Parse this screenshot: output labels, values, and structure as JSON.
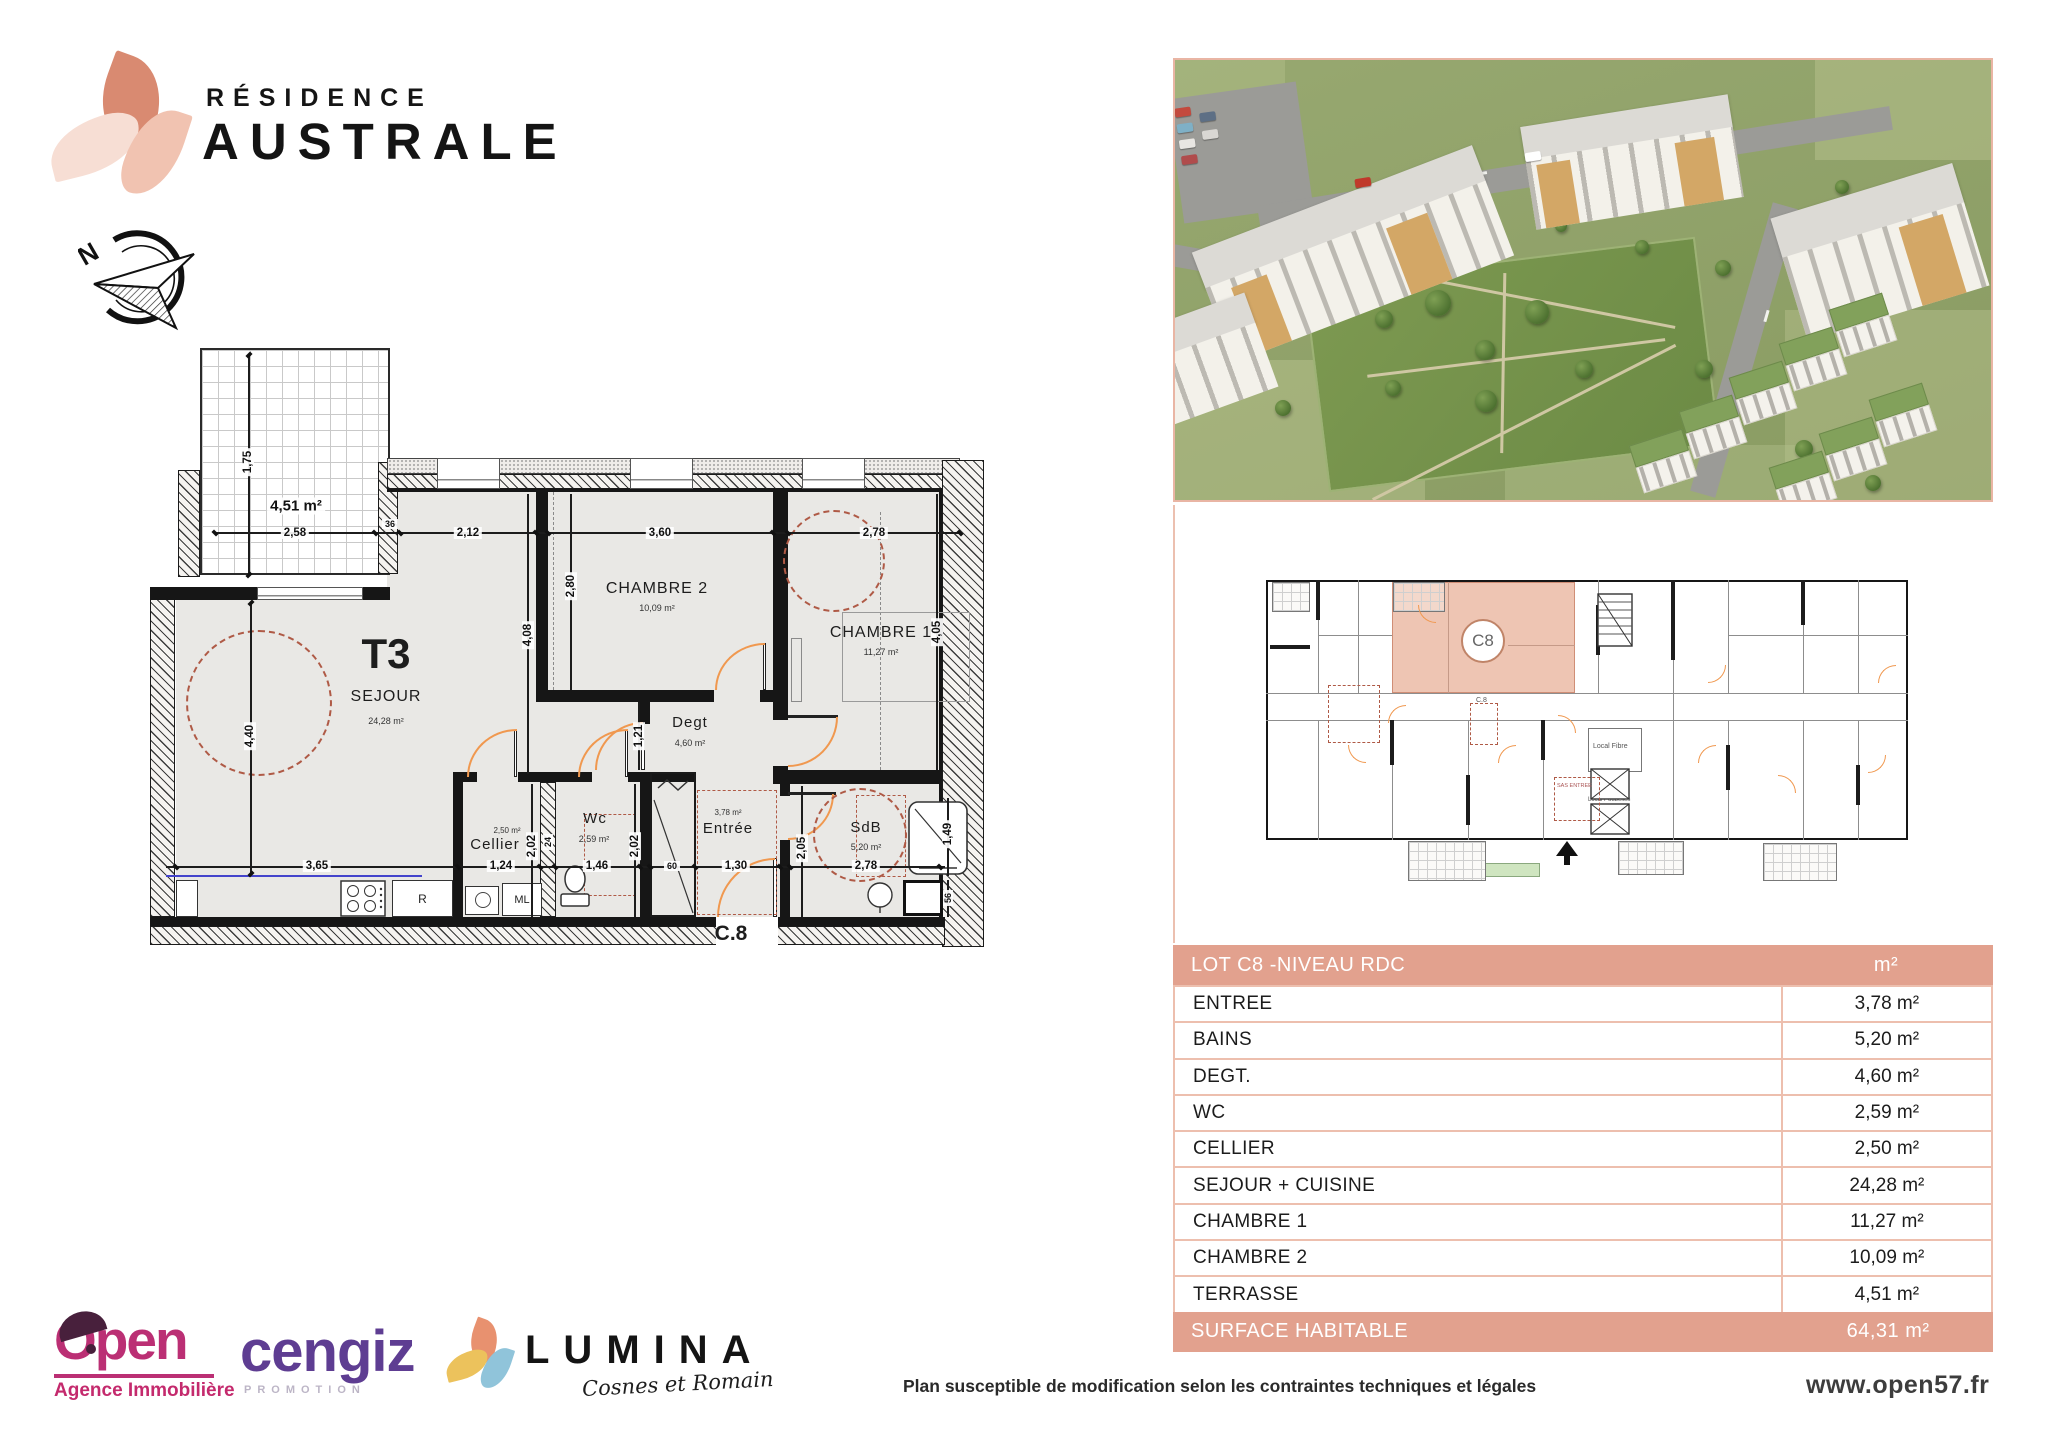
{
  "brand": {
    "line1": "RÉSIDENCE",
    "line2": "AUSTRALE"
  },
  "compass": {
    "north": "N"
  },
  "floor_plan": {
    "type": "T3",
    "lot": "C.8",
    "terrace": {
      "area": "4,51 m²"
    },
    "rooms": {
      "sejour": {
        "name": "SEJOUR",
        "area": "24,28 m²"
      },
      "chambre2": {
        "name": "CHAMBRE 2",
        "area": "10,09 m²"
      },
      "chambre1": {
        "name": "CHAMBRE 1",
        "area": "11,27 m²"
      },
      "degt": {
        "name": "Degt",
        "area": "4,60 m²"
      },
      "wc": {
        "name": "Wc",
        "area": "2,59 m²"
      },
      "cellier": {
        "name": "Cellier",
        "area": "2,50 m²"
      },
      "entree": {
        "name": "Entrée",
        "area": "3,78 m²"
      },
      "sdb": {
        "name": "SdB",
        "area": "5,20 m²"
      }
    },
    "appliances": {
      "fridge": "R",
      "washer": "ML"
    },
    "dims": {
      "terrace_h": "1,75",
      "terrace_w": "2,58",
      "wall36": "36",
      "seg_sejour": "2,12",
      "seg_ch2": "3,60",
      "seg_ch1": "2,78",
      "sejour_h": "4,40",
      "sejour_w": "3,65",
      "inner_col": "4,08",
      "ch2_h": "2,80",
      "ch1_h": "4,05",
      "degt_h": "1,21",
      "cellier_w": "1,24",
      "cellier_h": "2,02",
      "wc_w": "1,46",
      "wc_h": "2,02",
      "closet_w": "60",
      "entree_w": "1,30",
      "sdb_h": "2,05",
      "sdb_w": "2,78",
      "shower_h": "1,49",
      "shower_w": "56",
      "shaft_w": "24"
    }
  },
  "building_plan": {
    "badge": "C8",
    "lot": "C.8",
    "local_fibre": "Local Fibre",
    "local_poubelles": "Local Poubelles",
    "sas": "SAS ENTREE"
  },
  "table": {
    "header": {
      "title": "LOT C8 -NIVEAU RDC",
      "unit": "m²"
    },
    "rows": [
      {
        "label": "ENTREE",
        "value": "3,78 m²"
      },
      {
        "label": "BAINS",
        "value": "5,20 m²"
      },
      {
        "label": "DEGT.",
        "value": "4,60 m²"
      },
      {
        "label": "WC",
        "value": "2,59 m²"
      },
      {
        "label": "CELLIER",
        "value": "2,50 m²"
      },
      {
        "label": "SEJOUR + CUISINE",
        "value": "24,28 m²"
      },
      {
        "label": "CHAMBRE 1",
        "value": "11,27 m²"
      },
      {
        "label": "CHAMBRE 2",
        "value": "10,09 m²"
      },
      {
        "label": "TERRASSE",
        "value": "4,51 m²"
      }
    ],
    "footer": {
      "label": "SURFACE HABITABLE",
      "value": "64,31 m²"
    }
  },
  "footer": {
    "disclaimer": "Plan susceptible de modification selon les contraintes techniques et légales",
    "website": "www.open57.fr"
  },
  "partners": {
    "open": {
      "name": "Open",
      "subtitle": "Agence Immobilière"
    },
    "cengiz": {
      "name": "cengiz",
      "subtitle": "PROMOTION"
    },
    "lumina": {
      "name": "LUMINA",
      "subtitle": "Cosnes et Romain"
    }
  },
  "colors": {
    "salmon": "#E2A18E",
    "salmon_light": "#EDBFAE",
    "highlight": "#EEC5B3",
    "arc_orange": "#F0984F",
    "dashed_red": "#AF5A46",
    "magenta": "#BB2F74",
    "purple": "#5E3D92"
  }
}
